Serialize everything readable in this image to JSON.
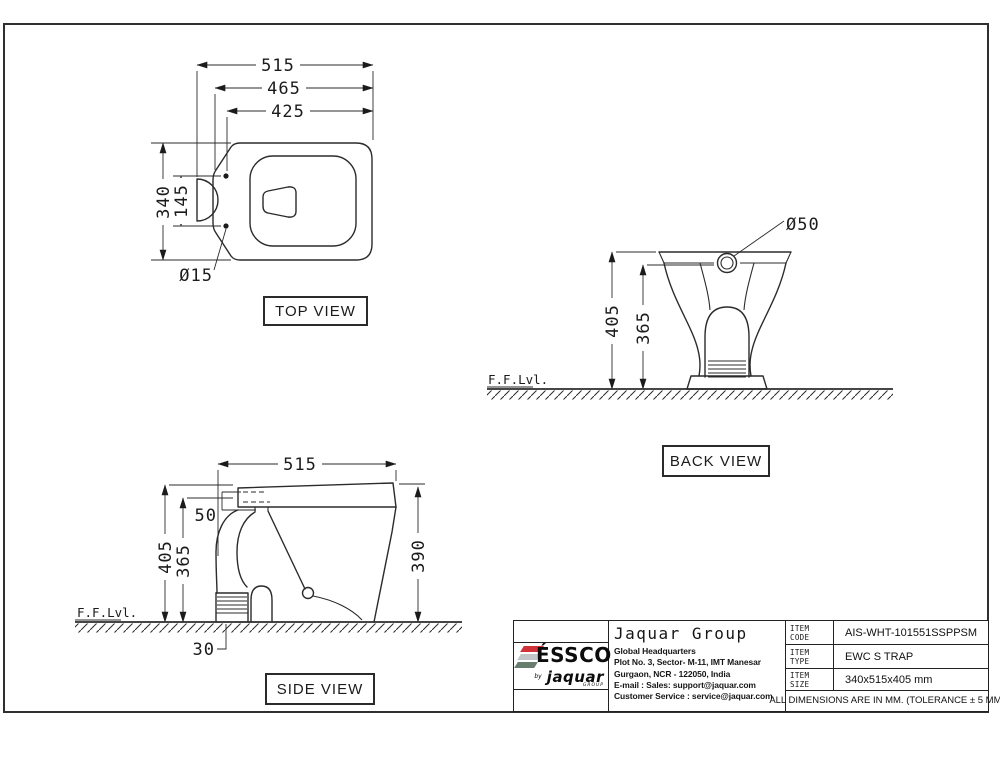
{
  "sheet": {
    "frame_color": "#2f2f2f",
    "bg": "#ffffff",
    "line_color": "#2b2b2b"
  },
  "views": {
    "top": {
      "label": "TOP VIEW",
      "dims": {
        "overall_length": "515",
        "body_length": "465",
        "hinge_distance": "425",
        "overall_width": "340",
        "hinge_span": "145",
        "hinge_hole_dia": "Ø15"
      }
    },
    "back": {
      "label": "BACK VIEW",
      "floor_label": "F.F.Lvl.",
      "dims": {
        "overall_height": "405",
        "inlet_height": "365",
        "inlet_dia": "Ø50"
      }
    },
    "side": {
      "label": "SIDE VIEW",
      "floor_label": "F.F.Lvl.",
      "dims": {
        "overall_length": "515",
        "tank_lip": "50",
        "overall_height": "405",
        "inlet_height": "365",
        "seat_height": "390",
        "outlet_offset": "30"
      }
    }
  },
  "title_block": {
    "brand": {
      "name": "ÉSSCO",
      "by": "by",
      "sub": "jaquar",
      "sub2": "GROUP"
    },
    "stripe_colors": {
      "red": "#cf3339",
      "gray": "#c3c6c8",
      "green": "#677d6e"
    },
    "company": "Jaquar Group",
    "address_lines": [
      "Global Headquarters",
      "Plot No. 3, Sector- M-11, IMT Manesar",
      "Gurgaon, NCR - 122050, India",
      "E-mail : Sales: support@jaquar.com",
      "Customer Service : service@jaquar.com"
    ],
    "rows": [
      {
        "label": "ITEM CODE",
        "value": "AIS-WHT-101551SSPPSM"
      },
      {
        "label": "ITEM TYPE",
        "value": "EWC S TRAP"
      },
      {
        "label": "ITEM SIZE",
        "value": "340x515x405 mm"
      }
    ],
    "note": "ALL DIMENSIONS ARE IN MM. (TOLERANCE ± 5 MM)"
  }
}
